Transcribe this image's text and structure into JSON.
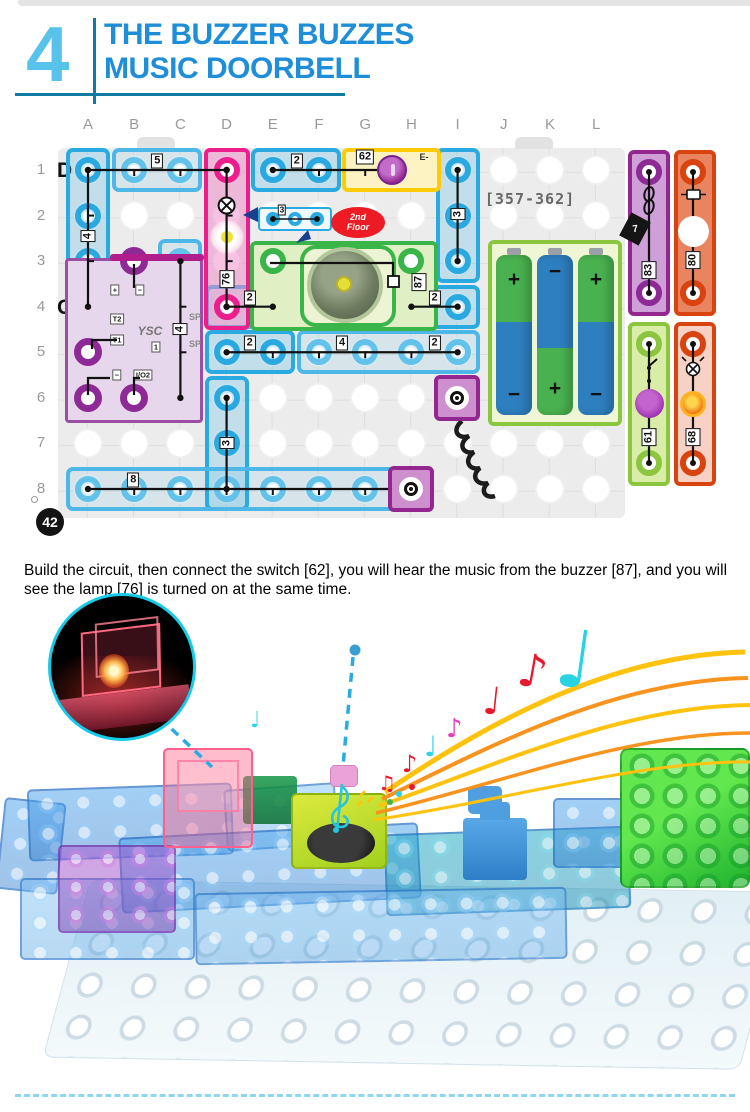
{
  "header": {
    "number": "4",
    "title_line1": "THE BUZZER BUZZES",
    "title_line2": "MUSIC DOORBELL"
  },
  "caption": "Build the circuit, then connect the switch [62], you will hear the music from the buzzer [87], and you will see the lamp [76] is turned on at the same time.",
  "step_badge": "42",
  "diagram": {
    "columns": [
      "A",
      "B",
      "C",
      "D",
      "E",
      "F",
      "G",
      "H",
      "I",
      "J",
      "K",
      "L"
    ],
    "rows": [
      "1",
      "2",
      "3",
      "4",
      "5",
      "6",
      "7",
      "8"
    ],
    "row_marker_top": "D",
    "row_marker_mid": "C",
    "board_code": "[357-362]",
    "second_floor_line1": "2nd",
    "second_floor_line2": "Floor",
    "floor_inset_label": "3",
    "switch_label": "62",
    "switch_terminal": "E-",
    "buzzer_label": "87",
    "module": {
      "logo": "YSC",
      "pins": [
        "+",
        "−",
        "T2",
        "T1",
        "−",
        "I/O2"
      ],
      "box": "1",
      "sp1": "SP",
      "sp2": "SP"
    },
    "battery": {
      "top_signs": [
        "+",
        "−",
        "+"
      ],
      "bottom_signs": [
        "−",
        "+",
        "−"
      ]
    },
    "strips": [
      {
        "label": "83",
        "chip": "7"
      },
      {
        "label": "80"
      },
      {
        "label": "61"
      },
      {
        "label": "68"
      }
    ],
    "pieces": [
      {
        "c": 0,
        "r": 1,
        "w": 1,
        "h": 4,
        "cls": "blue"
      },
      {
        "c": 1,
        "r": 1,
        "w": 2,
        "h": 1,
        "cls": "blue2"
      },
      {
        "c": 4,
        "r": 1,
        "w": 2,
        "h": 1,
        "cls": "blue"
      },
      {
        "c": 8,
        "r": 1,
        "w": 1,
        "h": 3,
        "cls": "blue"
      },
      {
        "c": 2,
        "r": 3,
        "w": 1,
        "h": 4,
        "cls": "blue2"
      },
      {
        "c": 3,
        "r": 4,
        "w": 2,
        "h": 1,
        "cls": "blue2"
      },
      {
        "c": 7,
        "r": 4,
        "w": 2,
        "h": 1,
        "cls": "blue"
      },
      {
        "c": 3,
        "r": 5,
        "w": 2,
        "h": 1,
        "cls": "blue"
      },
      {
        "c": 5,
        "r": 5,
        "w": 4,
        "h": 1,
        "cls": "blue2"
      },
      {
        "c": 3,
        "r": 6,
        "w": 1,
        "h": 3,
        "cls": "blue"
      },
      {
        "c": 0,
        "r": 8,
        "w": 8,
        "h": 1,
        "cls": "blue2"
      }
    ],
    "wires": [
      {
        "a": [
          0,
          1
        ],
        "b": [
          0,
          4
        ],
        "labels": [
          [
            "4",
            0.48
          ]
        ],
        "rot": true
      },
      {
        "a": [
          0,
          1
        ],
        "b": [
          3,
          1
        ],
        "labels": [
          [
            "5",
            0.5
          ]
        ]
      },
      {
        "a": [
          4,
          1
        ],
        "b": [
          6.6,
          1
        ],
        "labels": [
          [
            "2",
            0.2
          ]
        ]
      },
      {
        "a": [
          8,
          1
        ],
        "b": [
          8,
          3
        ],
        "labels": [
          [
            "3",
            0.48
          ]
        ],
        "rot": true
      },
      {
        "a": [
          2,
          3
        ],
        "b": [
          2,
          6
        ],
        "labels": [
          [
            "4",
            0.5
          ]
        ],
        "rot": true
      },
      {
        "a": [
          3,
          1
        ],
        "b": [
          3,
          4
        ],
        "labels": [
          [
            "76",
            0.8
          ]
        ],
        "rot": true,
        "sym": 0.26
      },
      {
        "a": [
          3,
          4
        ],
        "b": [
          4,
          4
        ],
        "labels": [
          [
            "2",
            0.5
          ]
        ]
      },
      {
        "a": [
          7,
          4
        ],
        "b": [
          8,
          4
        ],
        "labels": [
          [
            "2",
            0.5
          ]
        ]
      },
      {
        "a": [
          3,
          5
        ],
        "b": [
          8,
          5
        ],
        "labels": [
          [
            "2",
            0.1
          ],
          [
            "4",
            0.5
          ],
          [
            "2",
            0.9
          ]
        ]
      },
      {
        "a": [
          3,
          6
        ],
        "b": [
          3,
          8
        ],
        "labels": [
          [
            "3",
            0.49
          ]
        ],
        "rot": true
      },
      {
        "a": [
          0,
          8
        ],
        "b": [
          7,
          8
        ],
        "labels": [
          [
            "8",
            0.14
          ]
        ]
      },
      {
        "pts": [
          [
            240,
            151
          ],
          [
            363,
            151
          ],
          [
            363,
            167
          ]
        ],
        "nodots": true
      },
      {
        "pts": [
          [
            104,
            152
          ],
          [
            104,
            176
          ]
        ],
        "nodots": true
      },
      {
        "pts": [
          [
            87,
            228
          ],
          [
            62,
            228
          ],
          [
            62,
            237
          ]
        ],
        "nodots": true
      },
      {
        "pts": [
          [
            58,
            283
          ],
          [
            58,
            266
          ],
          [
            80,
            266
          ]
        ],
        "nodots": true
      },
      {
        "pts": [
          [
            104,
            283
          ],
          [
            104,
            266
          ],
          [
            110,
            266
          ]
        ],
        "nodots": true
      },
      {
        "pts": [
          [
            619,
            60
          ],
          [
            619,
            181
          ]
        ]
      },
      {
        "pts": [
          [
            663,
            60
          ],
          [
            663,
            181
          ]
        ]
      },
      {
        "pts": [
          [
            619,
            232
          ],
          [
            619,
            351
          ]
        ]
      },
      {
        "pts": [
          [
            663,
            232
          ],
          [
            663,
            351
          ]
        ]
      },
      {
        "pts": [
          [
            243,
            107
          ],
          [
            287,
            107
          ]
        ],
        "thin": true
      }
    ]
  },
  "photo": {
    "note_glyphs": {
      "eighth": "♪",
      "quarter": "♩",
      "beamed": "♫"
    }
  },
  "colors": {
    "accent_blue": "#29abe2",
    "title_blue": "#1e8ed9",
    "teal_rule": "#0f7ba3",
    "pink": "#ec1e8c",
    "yellow": "#ffcb05",
    "green": "#39b54a",
    "purple": "#93278f",
    "orange_red": "#d8430f",
    "staff_orange": "#f7931e",
    "staff_gold": "#ffc20e"
  }
}
